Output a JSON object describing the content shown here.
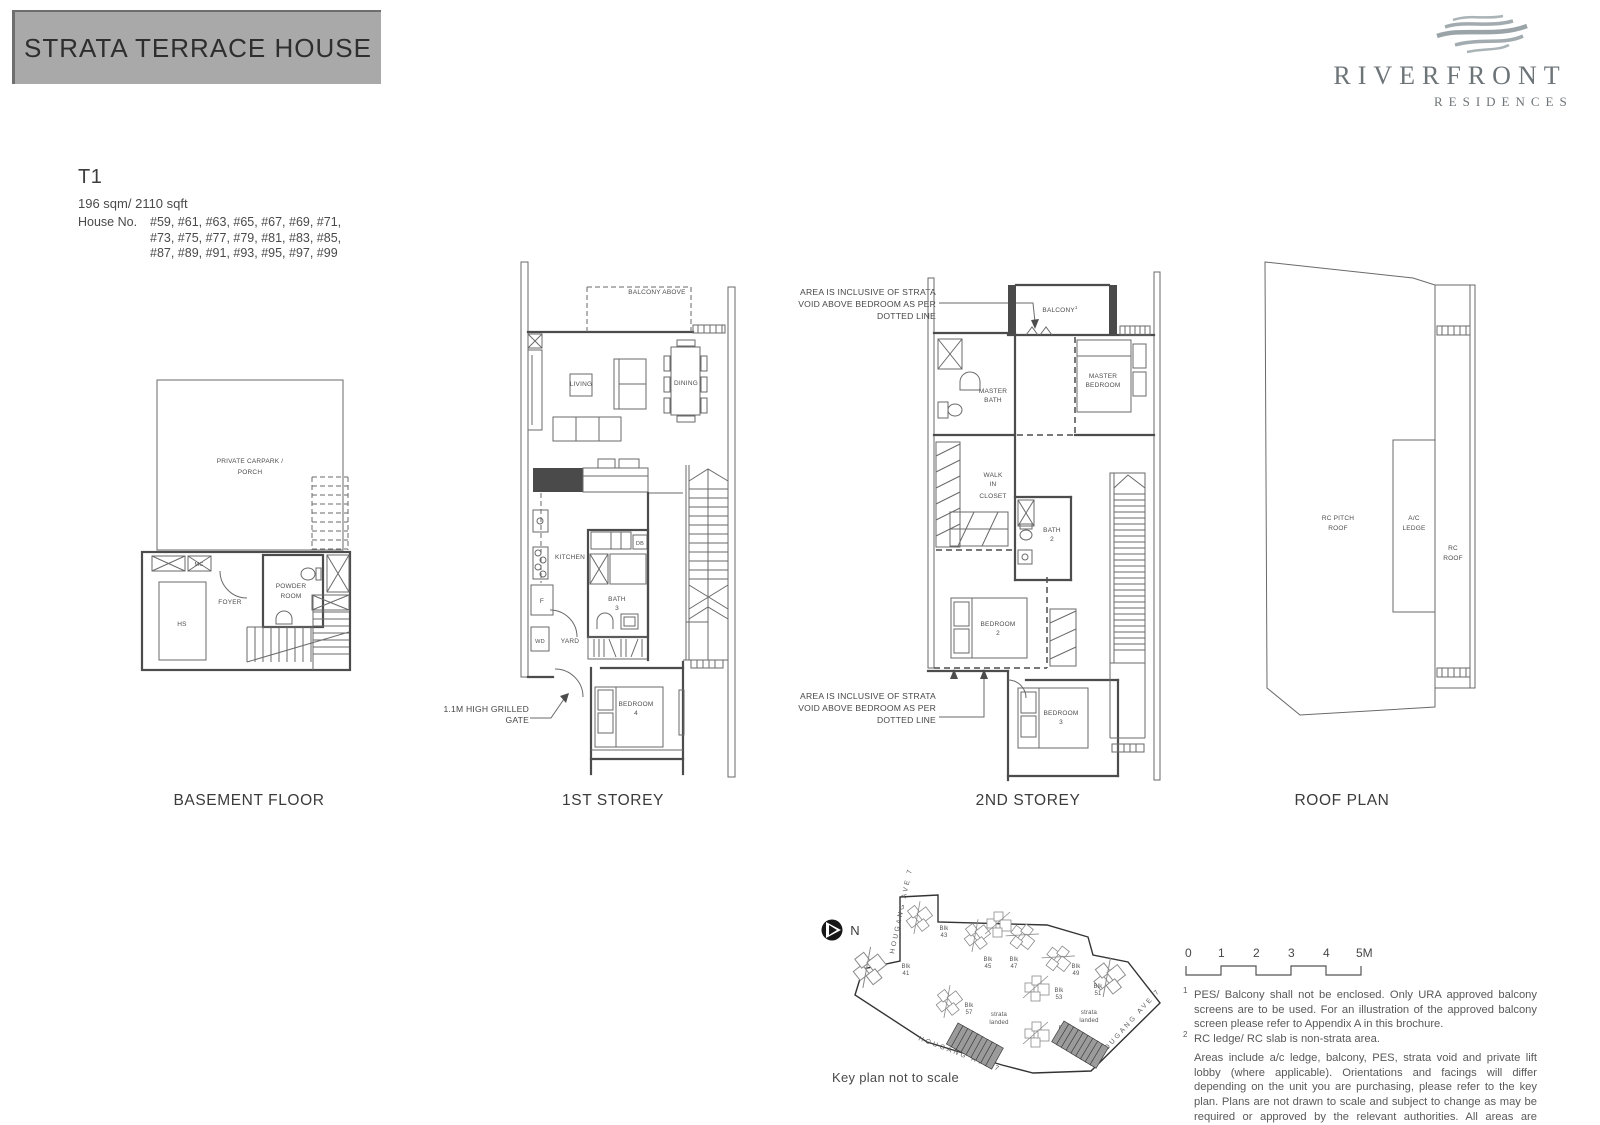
{
  "banner": {
    "title": "STRATA TERRACE HOUSE"
  },
  "logo": {
    "line1": "RIVERFRONT",
    "line2": "RESIDENCES"
  },
  "unit": {
    "code": "T1",
    "area": "196 sqm/ 2110 sqft",
    "house_label": "House No.",
    "house_lines": [
      "#59, #61, #63, #65, #67, #69, #71,",
      "#73, #75, #77, #79, #81, #83, #85,",
      "#87, #89, #91, #93, #95, #97, #99"
    ]
  },
  "floors": {
    "basement": "BASEMENT FLOOR",
    "first": "1ST STOREY",
    "second": "2ND STOREY",
    "roof": "ROOF PLAN"
  },
  "basement": {
    "carpark_l1": "PRIVATE CARPARK /",
    "carpark_l2": "PORCH",
    "mc": "MC",
    "hs": "HS",
    "foyer": "FOYER",
    "powder_l1": "POWDER",
    "powder_l2": "ROOM"
  },
  "first": {
    "balcony_above": "BALCONY ABOVE",
    "living": "LIVING",
    "dining": "DINING",
    "kitchen": "KITCHEN",
    "db": "DB",
    "fridge": "F",
    "bath_l1": "BATH",
    "bath_l2": "3",
    "wd": "WD",
    "yard": "YARD",
    "bedroom_l1": "BEDROOM",
    "bedroom_l2": "4",
    "gate_l1": "1.1M HIGH GRILLED",
    "gate_l2": "GATE"
  },
  "second": {
    "balcony": "BALCONY",
    "balcony_sup": "1",
    "master_bath_l1": "MASTER",
    "master_bath_l2": "BATH",
    "master_bed_l1": "MASTER",
    "master_bed_l2": "BEDROOM",
    "wic_l1": "WALK",
    "wic_l2": "IN",
    "wic_l3": "CLOSET",
    "bath2_l1": "BATH",
    "bath2_l2": "2",
    "bedroom2_l1": "BEDROOM",
    "bedroom2_l2": "2",
    "bedroom3_l1": "BEDROOM",
    "bedroom3_l2": "3",
    "void_note_l1": "** AREA IS INCLUSIVE OF STRATA",
    "void_note_l2": "VOID ABOVE BEDROOM AS PER",
    "void_note_l3": "DOTTED LINE"
  },
  "roof": {
    "pitch_l1": "RC PITCH",
    "pitch_l2": "ROOF",
    "ac_l1": "A/C",
    "ac_l2": "LEDGE",
    "rc_l1": "RC",
    "rc_l2": "ROOF"
  },
  "keyplan": {
    "north": "N",
    "street_left": "HOUGANG AVE 7",
    "street_bottom": "HOUGANG AVE 7",
    "street_right": "HOUGANG AVE 7",
    "caption": "Key plan not to scale",
    "strata_l1": "strata",
    "strata_l2": "landed",
    "blocks": [
      {
        "l1": "Blk",
        "l2": "43"
      },
      {
        "l1": "Blk",
        "l2": "45"
      },
      {
        "l1": "Blk",
        "l2": "47"
      },
      {
        "l1": "Blk",
        "l2": "41"
      },
      {
        "l1": "Blk",
        "l2": "49"
      },
      {
        "l1": "Blk",
        "l2": "51"
      },
      {
        "l1": "Blk",
        "l2": "53"
      },
      {
        "l1": "Blk",
        "l2": "57"
      },
      {
        "l1": "Blk",
        "l2": "55"
      }
    ]
  },
  "scalebar": {
    "t0": "0",
    "t1": "1",
    "t2": "2",
    "t3": "3",
    "t4": "4",
    "t5": "5M"
  },
  "notes": {
    "m1": "1",
    "n1": "PES/ Balcony shall not be enclosed. Only URA approved balcony screens are to be used. For an illustration of the approved balcony screen please refer to Appendix A in this brochure.",
    "m2": "2",
    "n2": "RC ledge/ RC slab is non-strata area.",
    "para": "Areas include a/c ledge, balcony, PES, strata void and private lift lobby (where applicable). Orientations and facings will differ depending on the unit you are purchasing, please refer to the key plan. Plans are not drawn to scale and subject to change as may be required or approved by the relevant authorities. All areas are estimates and are subject to final survey."
  },
  "colors": {
    "banner_bg": "#a9a9a9",
    "banner_edge": "#6e6e6e",
    "line": "#4c4c4c",
    "logo_gray": "#6d7478",
    "strata_fill": "#9b9b9b"
  }
}
